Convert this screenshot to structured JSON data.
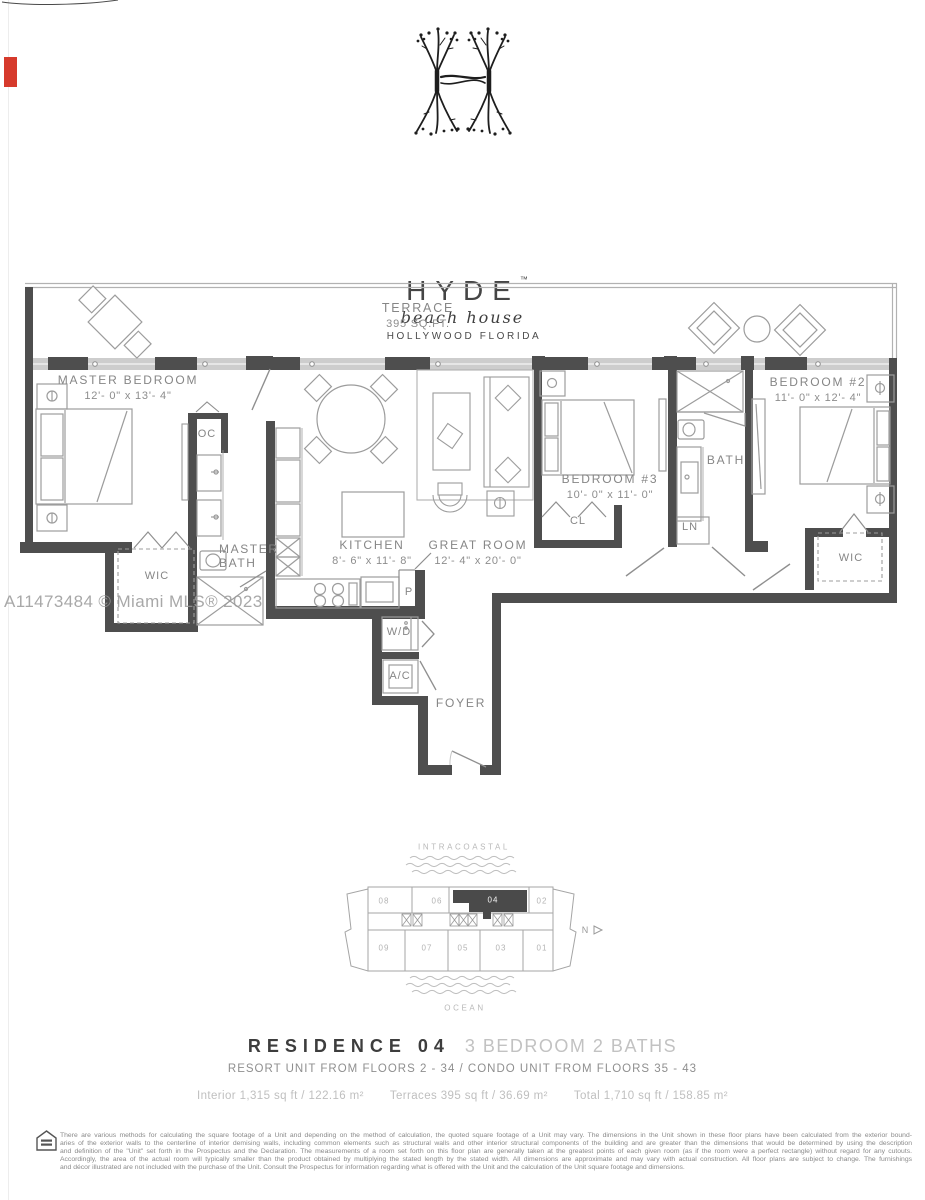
{
  "logo": {
    "brand": "HYDE",
    "tm": "™",
    "script": "beach house",
    "location": "HOLLYWOOD  FLORIDA"
  },
  "watermark": "A11473484 © Miami MLS® 2023",
  "plan": {
    "terrace_name": "TERRACE",
    "terrace_area": "395 SQ.FT.",
    "master_bedroom": "MASTER BEDROOM",
    "master_bedroom_dims": "12'- 0\" x 13'- 4\"",
    "kitchen": "KITCHEN",
    "kitchen_dims": "8'- 6\" x 11'- 8\"",
    "great_room": "GREAT ROOM",
    "great_room_dims": "12'- 4\" x 20'- 0\"",
    "bedroom3": "BEDROOM #3",
    "bedroom3_dims": "10'- 0\" x 11'- 0\"",
    "bedroom2": "BEDROOM #2",
    "bedroom2_dims": "11'- 0\" x 12'- 4\"",
    "master_bath_l1": "MASTER",
    "master_bath_l2": "BATH",
    "bath": "BATH",
    "foyer": "FOYER",
    "oc": "OC",
    "wic_master": "WIC",
    "wic_bedroom2": "WIC",
    "cl": "CL",
    "ln": "LN",
    "pantry": "P",
    "washer_dryer": "W/D",
    "ac": "A/C"
  },
  "keyplan": {
    "intracoastal": "INTRACOASTAL",
    "ocean": "OCEAN",
    "north": "N",
    "units_top": [
      "08",
      "06",
      "04",
      "02"
    ],
    "units_bottom": [
      "09",
      "07",
      "05",
      "03",
      "01"
    ],
    "highlighted_unit": "04"
  },
  "residence": {
    "title": "RESIDENCE 04",
    "subtitle": "3 BEDROOM 2 BATHS",
    "floors": "RESORT UNIT FROM FLOORS 2 - 34 / CONDO UNIT FROM FLOORS 35 - 43",
    "interior": "Interior 1,315 sq ft / 122.16 m²",
    "terraces": "Terraces 395 sq ft / 36.69 m²",
    "total": "Total 1,710 sq ft / 158.85 m²"
  },
  "disclaimer": {
    "lines": [
      "There are various methods for calculating the square footage of a Unit and depending on the method of calculation, the quoted square footage of a Unit may vary.  The dimensions in the Unit shown in these floor plans have been calculated from the exterior bound-",
      "aries of the exterior walls to the centerline of interior demising walls, including common elements such as structural walls and other interior structural components of the building and are greater than the dimensions that would be determined by using the description",
      "and definition of the \"Unit\" set forth in the Prospectus and the Declaration.  The measurements of a room set forth on this floor plan are generally taken at the greatest points of each given room (as if the room were a perfect rectangle) without regard for any cutouts.",
      "Accordingly, the area of the actual room will typically smaller than the product obtained by multiplying the stated length by the stated width.  All dimensions are approximate and may vary with actual construction. All floor plans are subject to change.  The furnishings",
      "and décor illustrated are not included with the purchase of the Unit.  Consult the Prospectus for information regarding what is offered with the Unit and the calculation of the Unit square footage and dimensions."
    ]
  },
  "colors": {
    "wall": "#4e4e4e",
    "line": "#9c9c9c",
    "label": "#868686",
    "slider_track": "#cdcdcd",
    "highlight_unit": "#4a4a4a",
    "marker_red": "#d63a2c"
  }
}
